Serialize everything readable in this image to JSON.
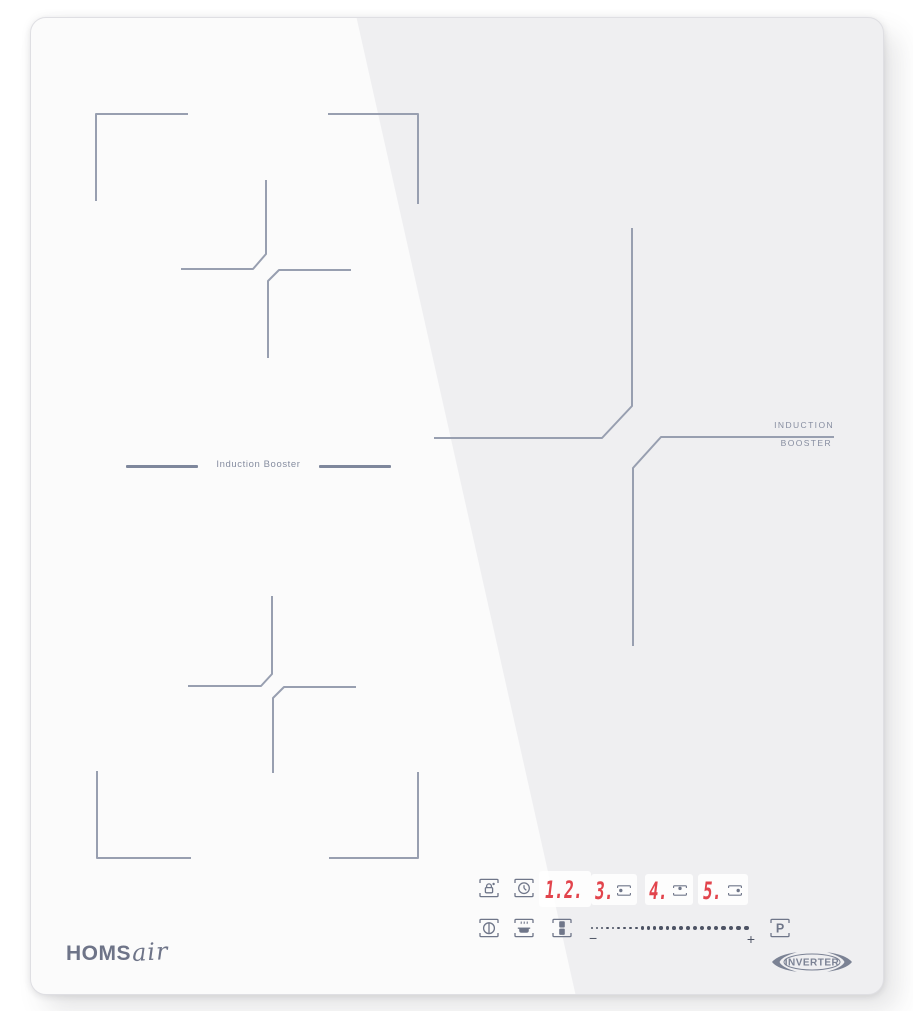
{
  "panel": {
    "bg_color": "#efeff1",
    "line_color": "#989fb0",
    "control_color": "#6f7689",
    "digit_color": "#e2444c"
  },
  "zones": {
    "flex_separator_label": "Induction Booster",
    "booster_label_line1": "INDUCTION",
    "booster_label_line2": "BOOSTER"
  },
  "controls": {
    "icons": {
      "lock": "child-lock-icon",
      "timer": "timer-clock-icon",
      "power": "power-standby-icon",
      "keep_warm": "keep-warm-pan-icon",
      "bridge": "bridge-zone-icon"
    },
    "displays": [
      {
        "value": "1.2.",
        "zone_dot": "none"
      },
      {
        "value": "3.",
        "zone_dot": "left"
      },
      {
        "value": "4.",
        "zone_dot": "top"
      },
      {
        "value": "5.",
        "zone_dot": "right"
      }
    ],
    "slider": {
      "minus_label": "−",
      "plus_label": "+",
      "dot_count": 25
    },
    "boost_button_label": "P"
  },
  "branding": {
    "logo_bold": "HOMS",
    "logo_script": "air",
    "badge_label": "INVERTER"
  }
}
